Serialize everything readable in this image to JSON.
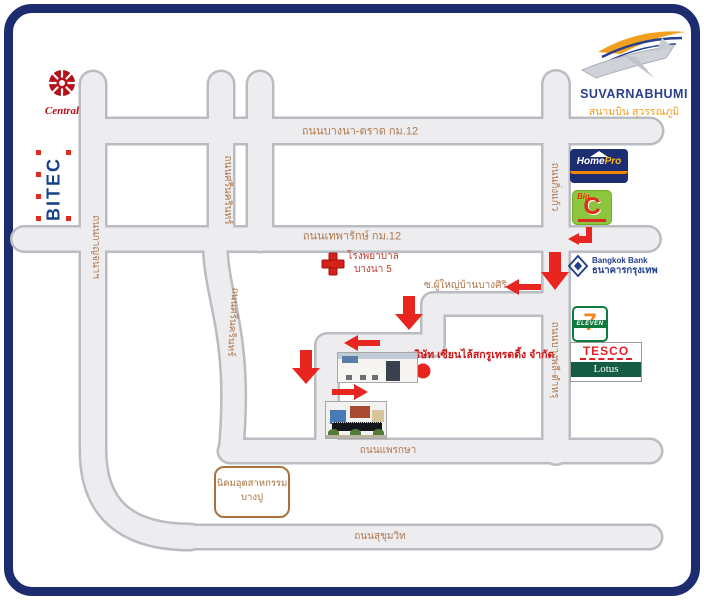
{
  "map": {
    "roads": {
      "bangna_trat": "ถนนบางนา-ตราด กม.12",
      "thepharak": "ถนนเทพารักษ์ กม.12",
      "kanchana": "ถนนกาญจนาฯ",
      "srinakarin": "ถนนศรีนครินทร์",
      "king_kaew": "ถนนกิ่งแก้ว",
      "bangphli_tamru": "ถนนบางพลี-ตำหรุ",
      "soi": "ซ.ผู้ใหญ่บ้านบางศิริ",
      "phraeksa": "ถนนแพรกษา",
      "sukhumvit": "ถนนสุขุมวิท"
    },
    "places": {
      "hospital_line1": "โรงพยาบาล",
      "hospital_line2": "บางนา 5",
      "company": "บริษัท เซียนไล้สกรูเทรดดิ้ง จำกัด",
      "bangpu_line1": "นิคมอุตสาหกรรม",
      "bangpu_line2": "บางปู"
    },
    "logos": {
      "central": "Central",
      "bitec": "BITEC",
      "suvarnabhumi_en": "SUVARNABHUMI",
      "suvarnabhumi_th": "สนามบิน สุวรรณภูมิ",
      "homepro_home": "Home",
      "homepro_pro": "Pro",
      "bigc_big": "Big",
      "bigc_c": "C",
      "bangkok_bank_en": "Bangkok Bank",
      "bangkok_bank_th": "ธนาคารกรุงเทพ",
      "seven": "7",
      "eleven": "ELEVEN",
      "tesco": "TESCO",
      "lotus": "Lotus"
    },
    "colors": {
      "frame_blue": "#1d2c6e",
      "road_fill": "#ededf0",
      "road_edge": "#b9bcc1",
      "label_brown": "#b0774a",
      "arrow_red": "#e8251f",
      "place_red": "#cf1515"
    }
  }
}
